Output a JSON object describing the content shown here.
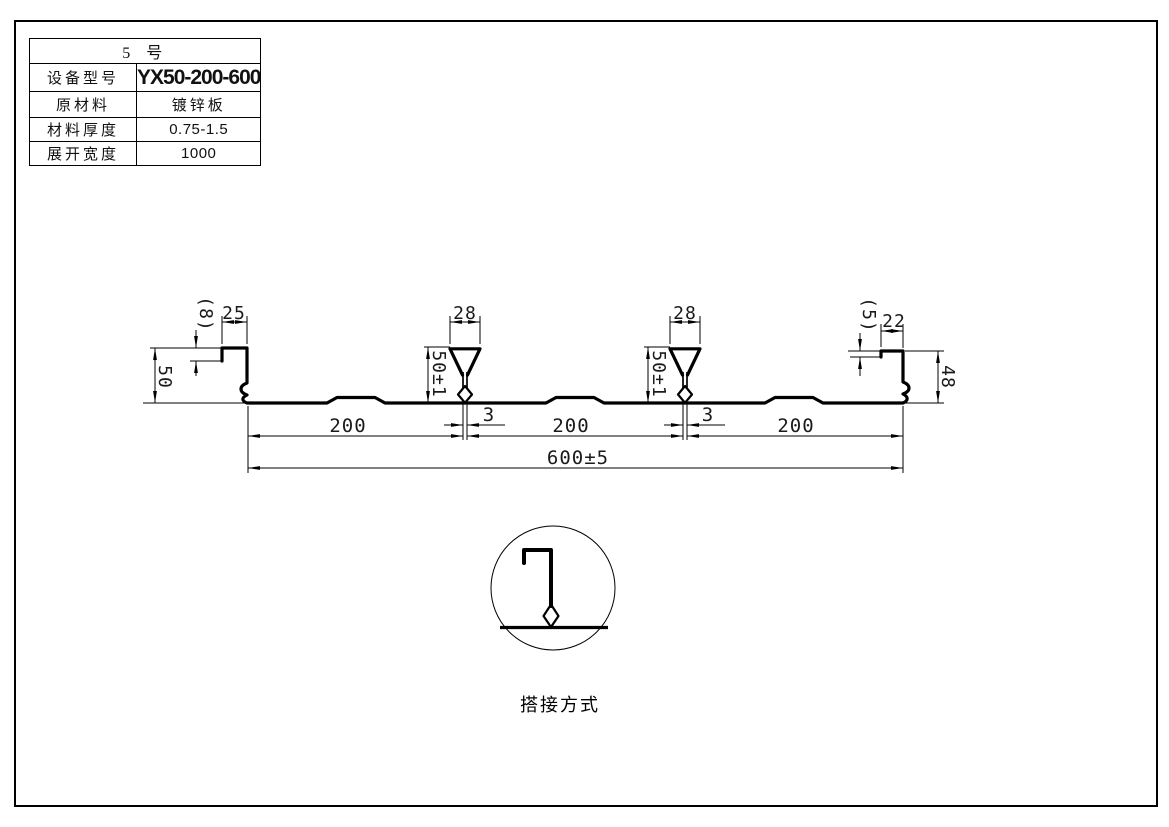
{
  "sheet": {
    "kind": "engineering-drawing"
  },
  "table": {
    "title": "5 号",
    "rows": [
      {
        "label": "设备型号",
        "value": "YX50-200-600"
      },
      {
        "label": "原材料",
        "value": "镀锌板"
      },
      {
        "label": "材料厚度",
        "value": "0.75-1.5"
      },
      {
        "label": "展开宽度",
        "value": "1000"
      }
    ]
  },
  "drawing": {
    "dims": {
      "left_height": "50",
      "left_lip": "(8)",
      "left_flange": "25",
      "rib1_width": "28",
      "rib2_width": "28",
      "rib1_height": "50±1",
      "rib2_height": "50±1",
      "right_lip": "(5)",
      "right_flange": "22",
      "right_height": "48",
      "span1": "200",
      "gap1": "3",
      "span2": "200",
      "gap2": "3",
      "span3": "200",
      "overall": "600±5"
    },
    "detail": {
      "label": "搭接方式"
    }
  },
  "colors": {
    "ink": "#000000",
    "paper": "#ffffff"
  }
}
